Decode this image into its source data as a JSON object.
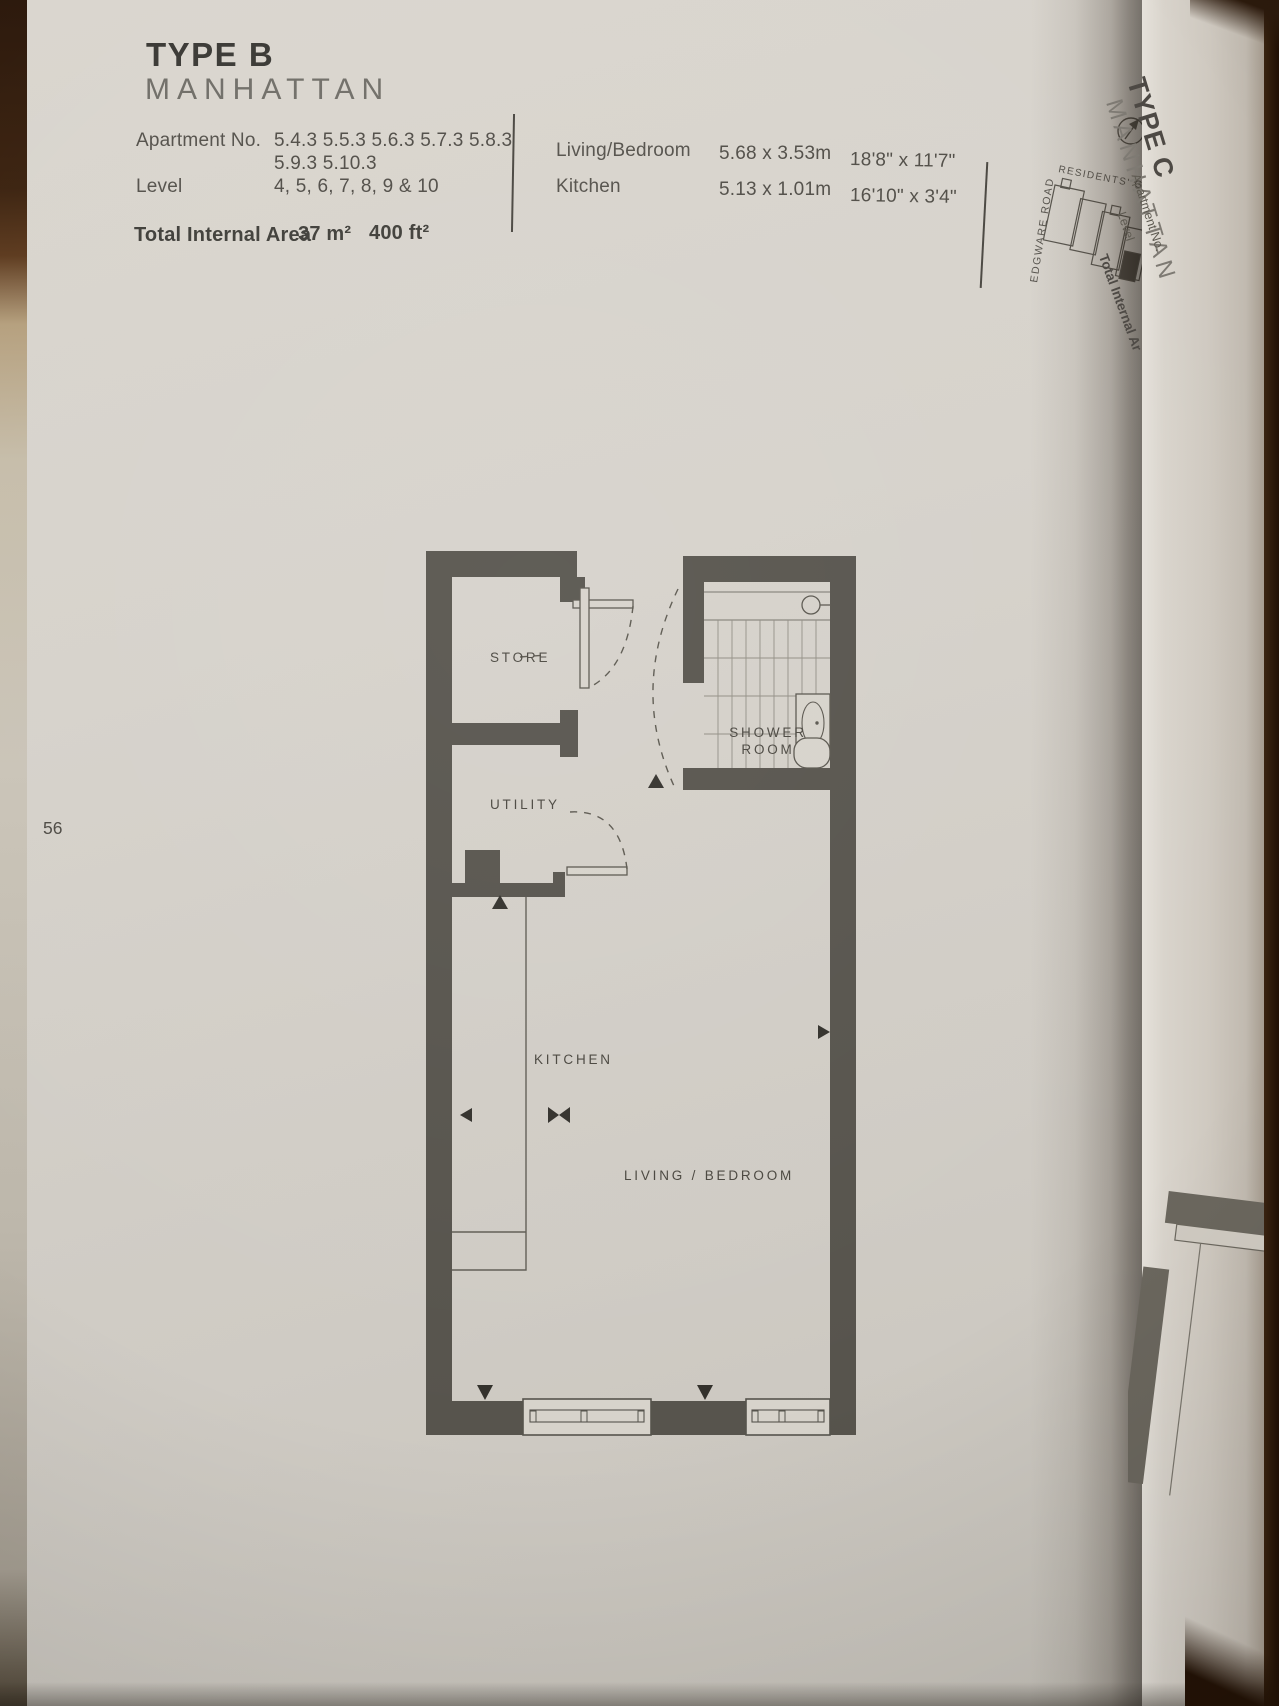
{
  "page": {
    "number": "56",
    "header": {
      "type": "TYPE B",
      "name": "MANHATTAN"
    },
    "info": {
      "apartment_label": "Apartment No.",
      "apartment_line1": "5.4.3 5.5.3 5.6.3 5.7.3 5.8.3",
      "apartment_line2": "5.9.3 5.10.3",
      "level_label": "Level",
      "level_value": "4, 5, 6, 7, 8, 9 & 10",
      "area_label": "Total Internal Area",
      "area_metric": "37 m²",
      "area_imperial": "400 ft²"
    },
    "dimensions": {
      "rows": [
        {
          "room": "Living/Bedroom",
          "metric": "5.68 x 3.53m",
          "imperial": "18'8\" x 11'7\""
        },
        {
          "room": "Kitchen",
          "metric": "5.13 x 1.01m",
          "imperial": "16'10\" x 3'4\""
        }
      ]
    },
    "site_map": {
      "road": "EDGWARE ROAD",
      "gardens": "RESIDENTS' GARDENS"
    },
    "floor_plan": {
      "store": "STORE",
      "utility": "UTILITY",
      "shower_line1": "SHOWER",
      "shower_line2": "ROOM",
      "kitchen": "KITCHEN",
      "living": "LIVING / BEDROOM"
    }
  },
  "next_page": {
    "type": "TYPE C",
    "name": "MANHATTAN",
    "apartment_label": "Apartment No.",
    "level_label": "Level",
    "area_label": "Total Internal Ar"
  },
  "colors": {
    "page": "#d5d1ca",
    "ink_dark": "#3d3c38",
    "ink": "#55524c",
    "wall": "#57544d",
    "cover_brown": "#33200f"
  }
}
